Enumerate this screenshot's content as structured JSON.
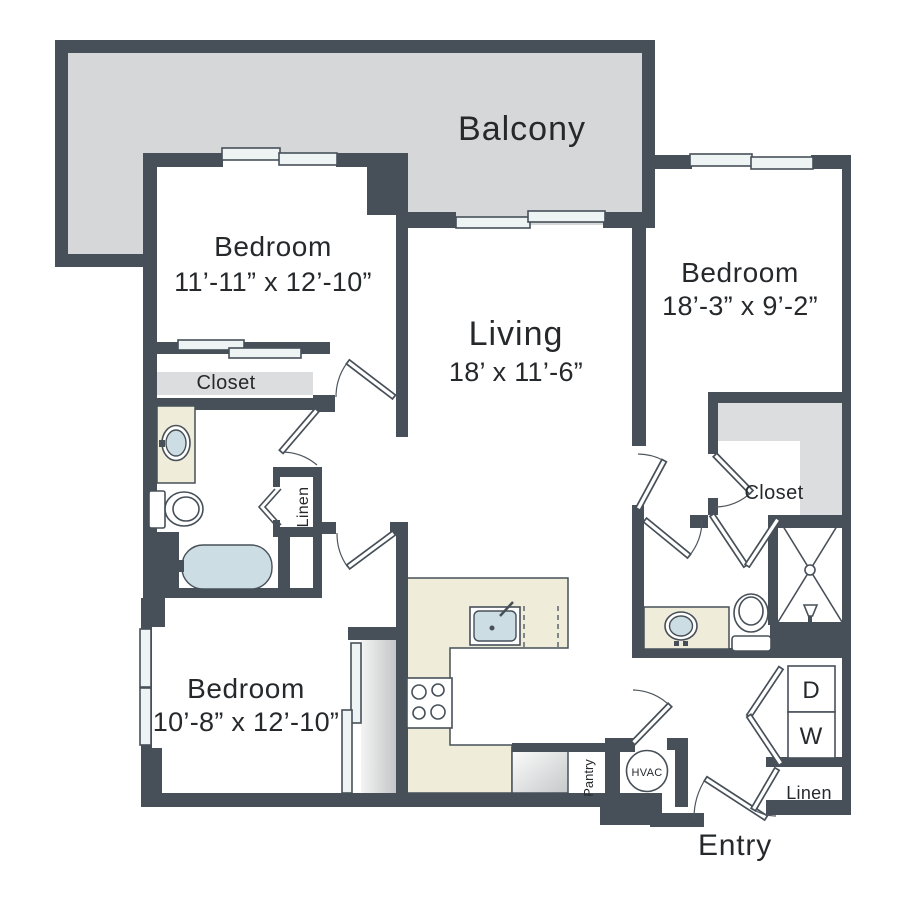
{
  "floor_plan": {
    "balcony": {
      "label": "Balcony"
    },
    "living_room": {
      "label": "Living",
      "dimensions": "18’ x 11’-6”"
    },
    "bedroom_top_left": {
      "label": "Bedroom",
      "dimensions": "11’-11” x 12’-10”"
    },
    "bedroom_right": {
      "label": "Bedroom",
      "dimensions": "18’-3” x 9’-2”"
    },
    "bedroom_bottom_left": {
      "label": "Bedroom",
      "dimensions": "10’-8” x 12’-10”"
    },
    "closet_bedroom_top_left": {
      "label": "Closet"
    },
    "closet_bedroom_right": {
      "label": "Closet"
    },
    "linen_bathroom": {
      "label": "Linen"
    },
    "linen_entry": {
      "label": "Linen"
    },
    "pantry": {
      "label": "Pantry"
    },
    "entry": {
      "label": "Entry"
    },
    "hvac": {
      "label": "HVAC"
    },
    "dryer": {
      "label": "D"
    },
    "washer": {
      "label": "W"
    },
    "colors": {
      "wall": "#475059",
      "balcony_floor": "#d5d7d8",
      "closet_shelf": "#dcddde",
      "counter": "#efecda",
      "fixture_blue": "#ccdde4",
      "window_pane": "#eef3f4",
      "text": "#26292c"
    }
  }
}
